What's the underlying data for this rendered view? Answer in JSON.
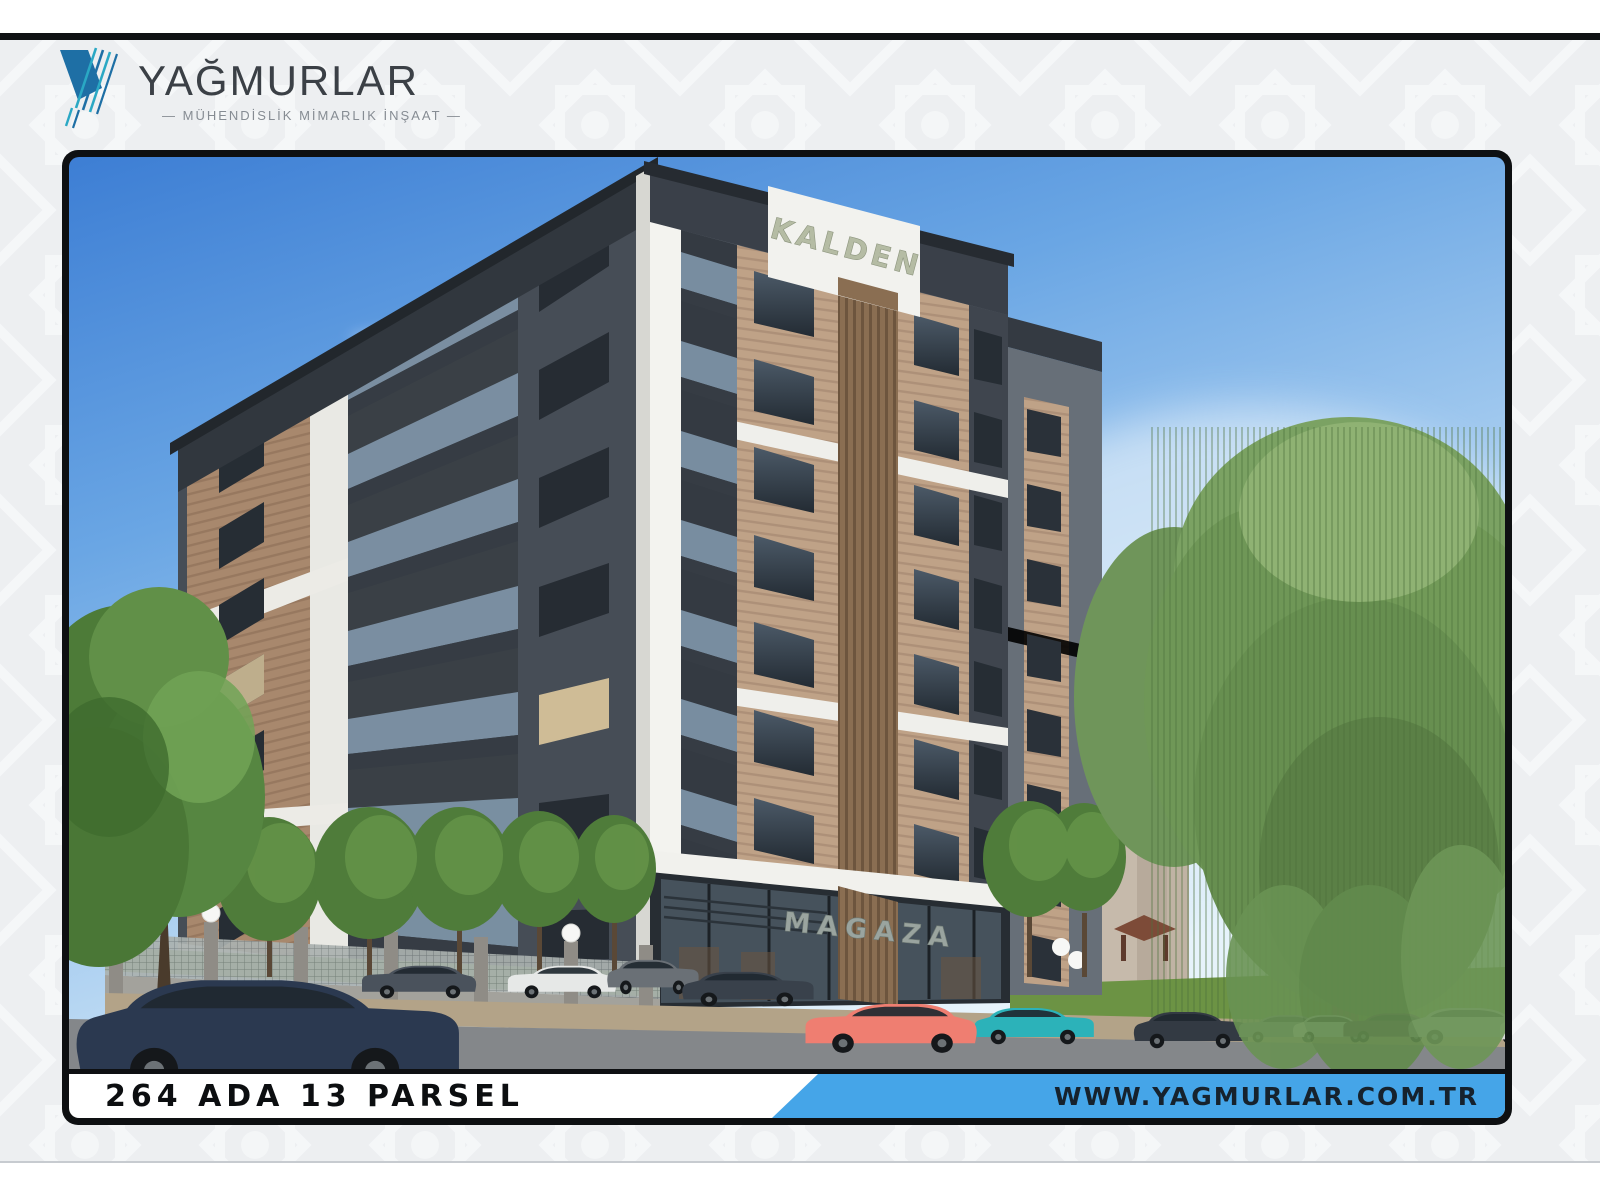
{
  "brand": {
    "name": "YAĞMURLAR",
    "tagline": "— MÜHENDİSLİK MİMARLIK İNŞAAT —",
    "mark_navy": "#1e6fa5",
    "mark_teal": "#2aa8c4",
    "text_color": "#3b4046"
  },
  "poster": {
    "building_sign": "KALDEN",
    "shop_sign": "MAGAZA"
  },
  "footer": {
    "parcel": "264 ADA 13 PARSEL",
    "website": "WWW.YAGMURLAR.COM.TR",
    "accent_blue": "#45a5e8"
  }
}
